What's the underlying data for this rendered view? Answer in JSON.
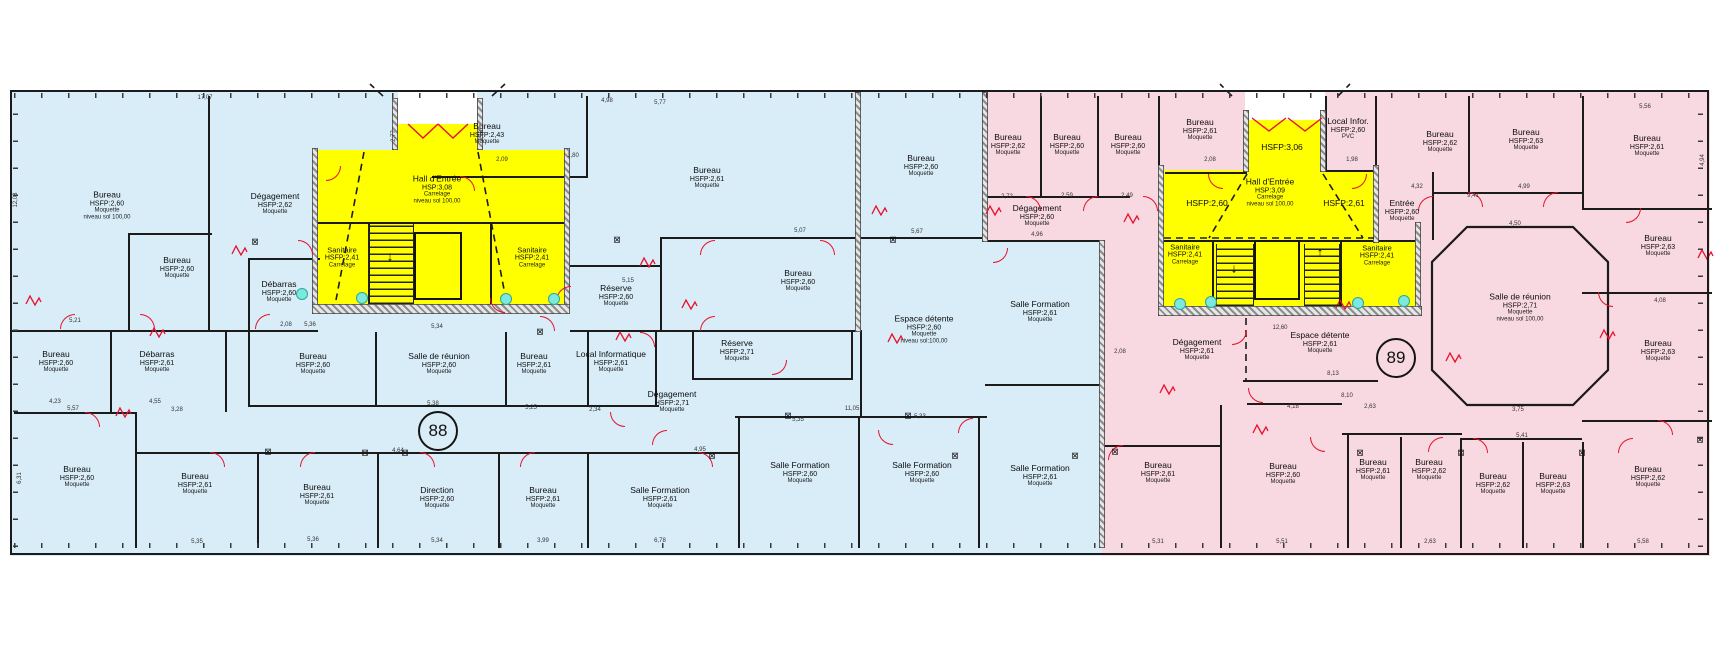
{
  "drawing": {
    "type": "architectural-floor-plan",
    "wings": [
      {
        "id": "left",
        "level_label": "88",
        "fill": "#d9edf8"
      },
      {
        "id": "right",
        "level_label": "89",
        "fill": "#f8d9e1"
      }
    ]
  },
  "colors": {
    "wing_left": "#d9edf8",
    "wing_right": "#f8d9e1",
    "core_yellow": "#ffff00",
    "door_red": "#e8112d",
    "wall_dark": "#1b1b1b",
    "fixture_cyan": "#7de8de"
  },
  "level_markers": [
    {
      "label": "88",
      "x": 438,
      "y": 431
    },
    {
      "label": "89",
      "x": 1396,
      "y": 358
    }
  ],
  "rooms": [
    {
      "lines": [
        "Bureau",
        "HSFP:2,60",
        "Moquette",
        "niveau sol 100,00"
      ],
      "x": 107,
      "y": 206
    },
    {
      "lines": [
        "Bureau",
        "HSFP:2,60",
        "Moquette"
      ],
      "x": 177,
      "y": 268
    },
    {
      "lines": [
        "Dégagement",
        "HSFP:2,62",
        "Moquette"
      ],
      "x": 275,
      "y": 204
    },
    {
      "lines": [
        "Débarras",
        "HSFP:2,60",
        "Moquette"
      ],
      "x": 279,
      "y": 292
    },
    {
      "lines": [
        "Sanitaire",
        "HSFP:2,41",
        "Carrelage"
      ],
      "x": 342,
      "y": 258,
      "small": true
    },
    {
      "lines": [
        "Sanitaire",
        "HSFP:2,41",
        "Carrelage"
      ],
      "x": 532,
      "y": 258,
      "small": true
    },
    {
      "lines": [
        "Hall d'Entrée",
        "HSP:3,08",
        "Carrelage",
        "niveau sol 100,00"
      ],
      "x": 437,
      "y": 190
    },
    {
      "lines": [
        "Bureau",
        "HSFP:2,43",
        "Moquette"
      ],
      "x": 487,
      "y": 134
    },
    {
      "lines": [
        "Bureau",
        "HSFP:2,61",
        "Moquette"
      ],
      "x": 707,
      "y": 178
    },
    {
      "lines": [
        "Bureau",
        "HSFP:2,60",
        "Moquette"
      ],
      "x": 921,
      "y": 166
    },
    {
      "lines": [
        "Réserve",
        "HSFP:2,60",
        "Moquette"
      ],
      "x": 616,
      "y": 296
    },
    {
      "lines": [
        "Bureau",
        "HSFP:2,60",
        "Moquette"
      ],
      "x": 798,
      "y": 281
    },
    {
      "lines": [
        "Réserve",
        "HSFP:2,71",
        "Moquette"
      ],
      "x": 737,
      "y": 351
    },
    {
      "lines": [
        "Espace détente",
        "HSFP:2,60",
        "Moquette",
        "niveau sol:100,00"
      ],
      "x": 924,
      "y": 330
    },
    {
      "lines": [
        "Bureau",
        "HSFP:2,60",
        "Moquette"
      ],
      "x": 56,
      "y": 362
    },
    {
      "lines": [
        "Débarras",
        "HSFP:2,61",
        "Moquette"
      ],
      "x": 157,
      "y": 362
    },
    {
      "lines": [
        "Bureau",
        "HSFP:2,60",
        "Moquette"
      ],
      "x": 313,
      "y": 364
    },
    {
      "lines": [
        "Salle de réunion",
        "HSFP:2,60",
        "Moquette"
      ],
      "x": 439,
      "y": 364
    },
    {
      "lines": [
        "Bureau",
        "HSFP:2,61",
        "Moquette"
      ],
      "x": 534,
      "y": 364
    },
    {
      "lines": [
        "Local Informatique",
        "HSFP:2,61",
        "Moquette"
      ],
      "x": 611,
      "y": 362
    },
    {
      "lines": [
        "Dégagement",
        "HSFP:2,71",
        "Moquette"
      ],
      "x": 672,
      "y": 402
    },
    {
      "lines": [
        "Bureau",
        "HSFP:2,60",
        "Moquette"
      ],
      "x": 77,
      "y": 477
    },
    {
      "lines": [
        "Bureau",
        "HSFP:2,61",
        "Moquette"
      ],
      "x": 195,
      "y": 484
    },
    {
      "lines": [
        "Bureau",
        "HSFP:2,61",
        "Moquette"
      ],
      "x": 317,
      "y": 495
    },
    {
      "lines": [
        "Direction",
        "HSFP:2,60",
        "Moquette"
      ],
      "x": 437,
      "y": 498
    },
    {
      "lines": [
        "Bureau",
        "HSFP:2,61",
        "Moquette"
      ],
      "x": 543,
      "y": 498
    },
    {
      "lines": [
        "Salle Formation",
        "HSFP:2,61",
        "Moquette"
      ],
      "x": 660,
      "y": 498
    },
    {
      "lines": [
        "Salle Formation",
        "HSFP:2,60",
        "Moquette"
      ],
      "x": 800,
      "y": 473
    },
    {
      "lines": [
        "Salle Formation",
        "HSFP:2,60",
        "Moquette"
      ],
      "x": 922,
      "y": 473
    },
    {
      "lines": [
        "Salle Formation",
        "HSFP:2,61",
        "Moquette"
      ],
      "x": 1040,
      "y": 312
    },
    {
      "lines": [
        "Salle Formation",
        "HSFP:2,61",
        "Moquette"
      ],
      "x": 1040,
      "y": 476
    },
    {
      "lines": [
        "Bureau",
        "HSFP:2,62",
        "Moquette"
      ],
      "x": 1008,
      "y": 145
    },
    {
      "lines": [
        "Bureau",
        "HSFP:2,60",
        "Moquette"
      ],
      "x": 1067,
      "y": 145
    },
    {
      "lines": [
        "Bureau",
        "HSFP:2,60",
        "Moquette"
      ],
      "x": 1128,
      "y": 145
    },
    {
      "lines": [
        "Bureau",
        "HSFP:2,61",
        "Moquette"
      ],
      "x": 1200,
      "y": 130
    },
    {
      "lines": [
        "Dégagement",
        "HSFP:2,60",
        "Moquette"
      ],
      "x": 1037,
      "y": 216
    },
    {
      "lines": [
        "HSFP:3,06"
      ],
      "x": 1282,
      "y": 148
    },
    {
      "lines": [
        "Hall d'Entrée",
        "HSP:3,09",
        "Carrelage",
        "niveau sol 100,00"
      ],
      "x": 1270,
      "y": 193
    },
    {
      "lines": [
        "HSFP:2,60"
      ],
      "x": 1207,
      "y": 204
    },
    {
      "lines": [
        "HSFP:2,61"
      ],
      "x": 1344,
      "y": 204
    },
    {
      "lines": [
        "Local Infor.",
        "HSFP:2,60",
        "PVC"
      ],
      "x": 1348,
      "y": 129
    },
    {
      "lines": [
        "Entrée",
        "HSFP:2,60",
        "Moquette"
      ],
      "x": 1402,
      "y": 211
    },
    {
      "lines": [
        "Sanitaire",
        "HSFP:2,41",
        "Carrelage"
      ],
      "x": 1185,
      "y": 255,
      "small": true
    },
    {
      "lines": [
        "Sanitaire",
        "HSFP:2,41",
        "Carrelage"
      ],
      "x": 1377,
      "y": 256,
      "small": true
    },
    {
      "lines": [
        "Bureau",
        "HSFP:2,62",
        "Moquette"
      ],
      "x": 1440,
      "y": 142
    },
    {
      "lines": [
        "Bureau",
        "HSFP:2,63",
        "Moquette"
      ],
      "x": 1526,
      "y": 140
    },
    {
      "lines": [
        "Bureau",
        "HSFP:2,61",
        "Moquette"
      ],
      "x": 1647,
      "y": 146
    },
    {
      "lines": [
        "Bureau",
        "HSFP:2,63",
        "Moquette"
      ],
      "x": 1658,
      "y": 246
    },
    {
      "lines": [
        "Salle de réunion",
        "HSFP:2,71",
        "Moquette",
        "niveau sol 100,00"
      ],
      "x": 1520,
      "y": 308
    },
    {
      "lines": [
        "Bureau",
        "HSFP:2,63",
        "Moquette"
      ],
      "x": 1658,
      "y": 351
    },
    {
      "lines": [
        "Dégagement",
        "HSFP:2,61",
        "Moquette"
      ],
      "x": 1197,
      "y": 350
    },
    {
      "lines": [
        "Espace détente",
        "HSFP:2,61",
        "Moquette"
      ],
      "x": 1320,
      "y": 343
    },
    {
      "lines": [
        "Bureau",
        "HSFP:2,61",
        "Moquette"
      ],
      "x": 1158,
      "y": 473
    },
    {
      "lines": [
        "Bureau",
        "HSFP:2,60",
        "Moquette"
      ],
      "x": 1283,
      "y": 474
    },
    {
      "lines": [
        "Bureau",
        "HSFP:2,61",
        "Moquette"
      ],
      "x": 1373,
      "y": 470
    },
    {
      "lines": [
        "Bureau",
        "HSFP:2,62",
        "Moquette"
      ],
      "x": 1429,
      "y": 470
    },
    {
      "lines": [
        "Bureau",
        "HSFP:2,62",
        "Moquette"
      ],
      "x": 1493,
      "y": 484
    },
    {
      "lines": [
        "Bureau",
        "HSFP:2,63",
        "Moquette"
      ],
      "x": 1553,
      "y": 484
    },
    {
      "lines": [
        "Bureau",
        "HSFP:2,62",
        "Moquette"
      ],
      "x": 1648,
      "y": 477
    }
  ],
  "dims": [
    {
      "t": "17,07",
      "x": 205,
      "y": 98,
      "r": 0
    },
    {
      "t": "12,08",
      "x": 16,
      "y": 200,
      "r": 1
    },
    {
      "t": "2,77",
      "x": 394,
      "y": 136,
      "r": 1
    },
    {
      "t": "2,76",
      "x": 482,
      "y": 136,
      "r": 1
    },
    {
      "t": "2,09",
      "x": 502,
      "y": 160,
      "r": 0
    },
    {
      "t": "1,80",
      "x": 573,
      "y": 156,
      "r": 0
    },
    {
      "t": "4,98",
      "x": 607,
      "y": 101,
      "r": 0
    },
    {
      "t": "5,77",
      "x": 660,
      "y": 103,
      "r": 0
    },
    {
      "t": "5,34",
      "x": 437,
      "y": 327,
      "r": 0
    },
    {
      "t": "5,36",
      "x": 310,
      "y": 325,
      "r": 0
    },
    {
      "t": "2,08",
      "x": 286,
      "y": 325,
      "r": 0
    },
    {
      "t": "5,21",
      "x": 75,
      "y": 321,
      "r": 0
    },
    {
      "t": "5,15",
      "x": 628,
      "y": 281,
      "r": 0
    },
    {
      "t": "5,07",
      "x": 800,
      "y": 231,
      "r": 0
    },
    {
      "t": "5,67",
      "x": 917,
      "y": 232,
      "r": 0
    },
    {
      "t": "5,57",
      "x": 73,
      "y": 409,
      "r": 0
    },
    {
      "t": "3,28",
      "x": 177,
      "y": 410,
      "r": 0
    },
    {
      "t": "4,23",
      "x": 55,
      "y": 402,
      "r": 0
    },
    {
      "t": "4,55",
      "x": 155,
      "y": 402,
      "r": 0
    },
    {
      "t": "5,35",
      "x": 197,
      "y": 542,
      "r": 0
    },
    {
      "t": "5,36",
      "x": 313,
      "y": 540,
      "r": 0
    },
    {
      "t": "6,31",
      "x": 20,
      "y": 478,
      "r": 1
    },
    {
      "t": "5,38",
      "x": 433,
      "y": 404,
      "r": 0
    },
    {
      "t": "5,25",
      "x": 531,
      "y": 408,
      "r": 0
    },
    {
      "t": "2,34",
      "x": 595,
      "y": 410,
      "r": 0
    },
    {
      "t": "4,64",
      "x": 398,
      "y": 451,
      "r": 0
    },
    {
      "t": "5,34",
      "x": 437,
      "y": 541,
      "r": 0
    },
    {
      "t": "3,99",
      "x": 543,
      "y": 541,
      "r": 0
    },
    {
      "t": "6,78",
      "x": 660,
      "y": 541,
      "r": 0
    },
    {
      "t": "11,05",
      "x": 852,
      "y": 409,
      "r": 0
    },
    {
      "t": "5,35",
      "x": 798,
      "y": 420,
      "r": 0
    },
    {
      "t": "5,33",
      "x": 920,
      "y": 417,
      "r": 0
    },
    {
      "t": "4,95",
      "x": 700,
      "y": 450,
      "r": 0
    },
    {
      "t": "2,72",
      "x": 1007,
      "y": 197,
      "r": 0
    },
    {
      "t": "2,59",
      "x": 1067,
      "y": 196,
      "r": 0
    },
    {
      "t": "2,49",
      "x": 1127,
      "y": 196,
      "r": 0
    },
    {
      "t": "2,08",
      "x": 1210,
      "y": 160,
      "r": 0
    },
    {
      "t": "4,96",
      "x": 1037,
      "y": 235,
      "r": 0
    },
    {
      "t": "1,98",
      "x": 1352,
      "y": 160,
      "r": 0
    },
    {
      "t": "4,32",
      "x": 1417,
      "y": 187,
      "r": 0
    },
    {
      "t": "4,99",
      "x": 1524,
      "y": 187,
      "r": 0
    },
    {
      "t": "9,41",
      "x": 1473,
      "y": 196,
      "r": 0
    },
    {
      "t": "5,56",
      "x": 1645,
      "y": 107,
      "r": 0
    },
    {
      "t": "4,94",
      "x": 1703,
      "y": 160,
      "r": 1
    },
    {
      "t": "4,50",
      "x": 1515,
      "y": 224,
      "r": 0
    },
    {
      "t": "8,13",
      "x": 1333,
      "y": 374,
      "r": 0
    },
    {
      "t": "8,10",
      "x": 1347,
      "y": 396,
      "r": 0
    },
    {
      "t": "4,18",
      "x": 1293,
      "y": 407,
      "r": 0
    },
    {
      "t": "2,63",
      "x": 1370,
      "y": 407,
      "r": 0
    },
    {
      "t": "5,41",
      "x": 1522,
      "y": 436,
      "r": 0
    },
    {
      "t": "3,75",
      "x": 1518,
      "y": 410,
      "r": 0
    },
    {
      "t": "4,08",
      "x": 1660,
      "y": 301,
      "r": 0
    },
    {
      "t": "5,58",
      "x": 1643,
      "y": 542,
      "r": 0
    },
    {
      "t": "2,63",
      "x": 1430,
      "y": 542,
      "r": 0
    },
    {
      "t": "5,31",
      "x": 1158,
      "y": 542,
      "r": 0
    },
    {
      "t": "5,51",
      "x": 1282,
      "y": 542,
      "r": 0
    },
    {
      "t": "2,08",
      "x": 1120,
      "y": 352,
      "r": 0
    },
    {
      "t": "12,60",
      "x": 1280,
      "y": 328,
      "r": 0
    }
  ]
}
